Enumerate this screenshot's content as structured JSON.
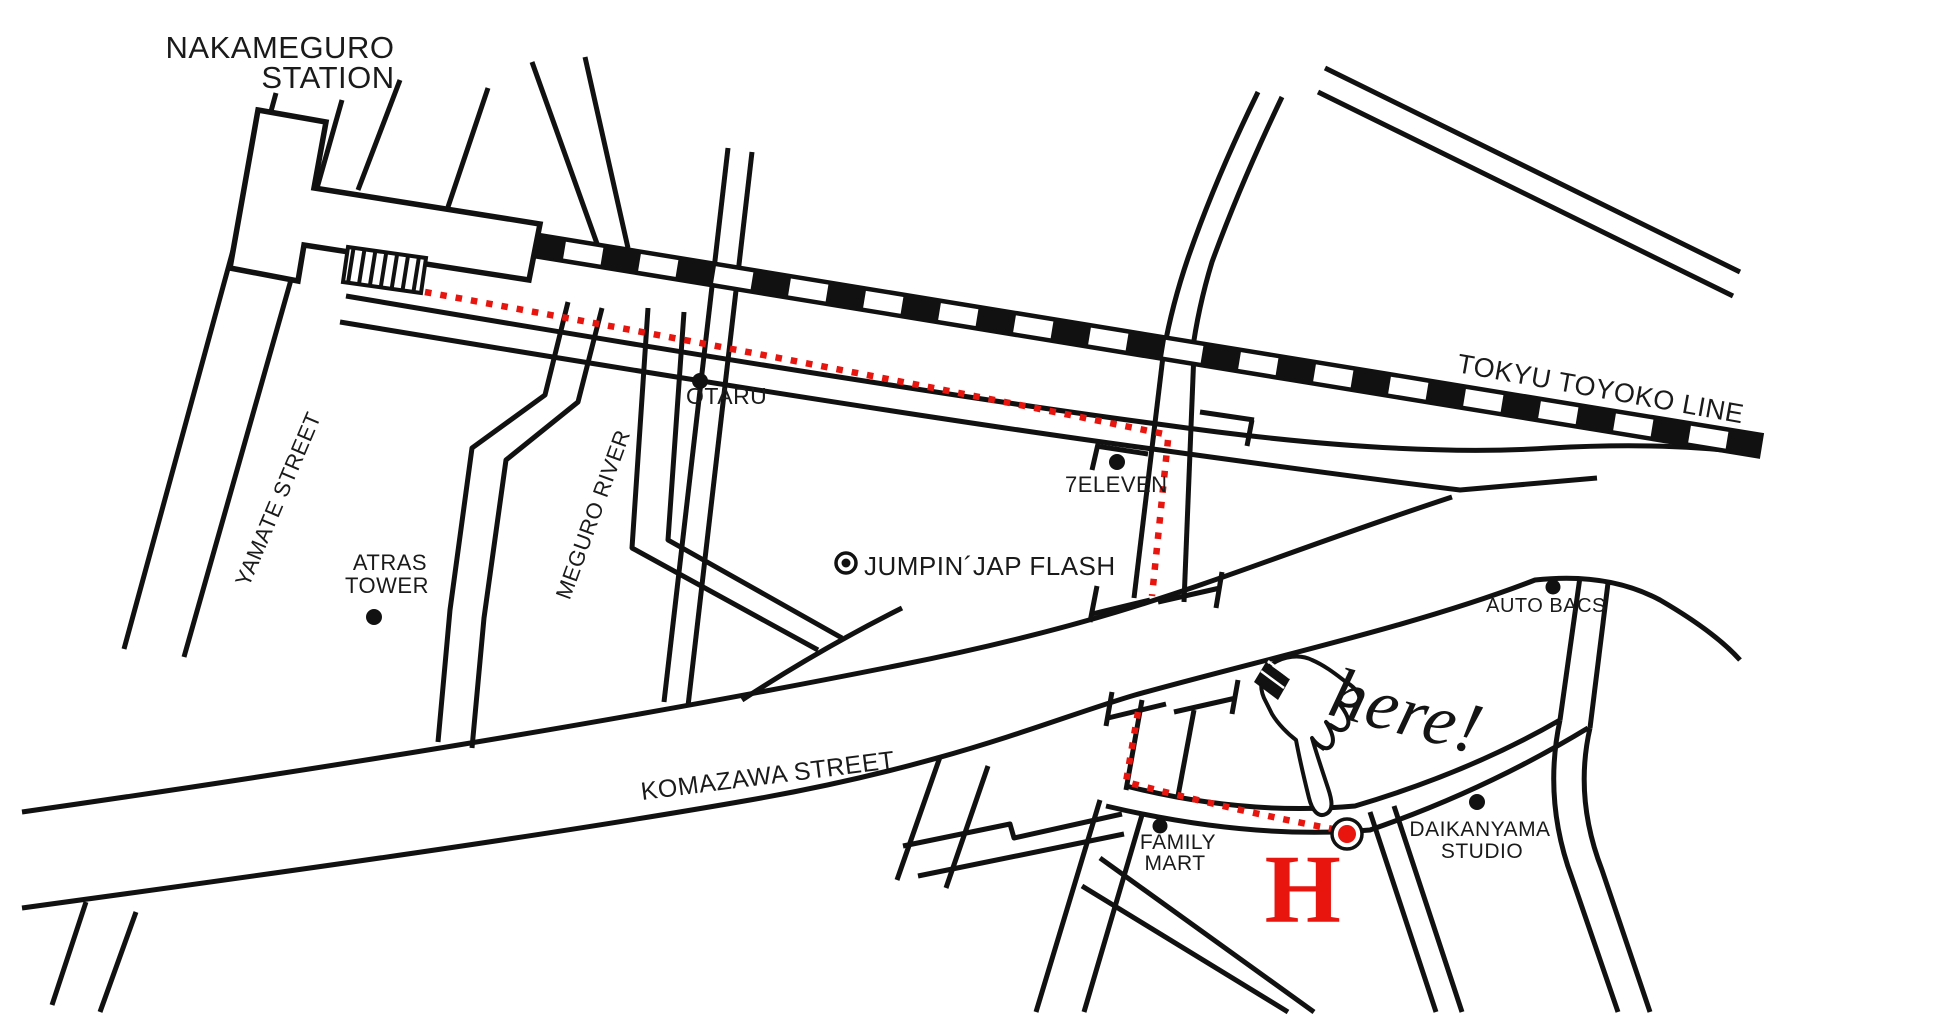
{
  "map": {
    "station": {
      "line1": "NAKAMEGURO",
      "line2": "STATION"
    },
    "railway": {
      "label": "TOKYU TOYOKO LINE"
    },
    "streets": {
      "yamate": "YAMATE STREET",
      "meguro_river": "MEGURO RIVER",
      "komazawa": "KOMAZAWA STREET"
    },
    "pois": {
      "otaru": "OTARU",
      "atras_tower": {
        "line1": "ATRAS",
        "line2": "TOWER"
      },
      "jumpin_jap_flash": "JUMPIN´JAP FLASH",
      "seven_eleven": "7ELEVEN",
      "auto_bacs": "AUTO BACS",
      "family_mart": {
        "line1": "FAMILY",
        "line2": "MART"
      },
      "daikanyama_studio": {
        "line1": "DAIKANYAMA",
        "line2": "STUDIO"
      }
    },
    "destination": {
      "callout": "here!",
      "marker": "H"
    },
    "colors": {
      "route_red": "#e8140e",
      "ink": "#111111",
      "background": "#ffffff"
    }
  }
}
